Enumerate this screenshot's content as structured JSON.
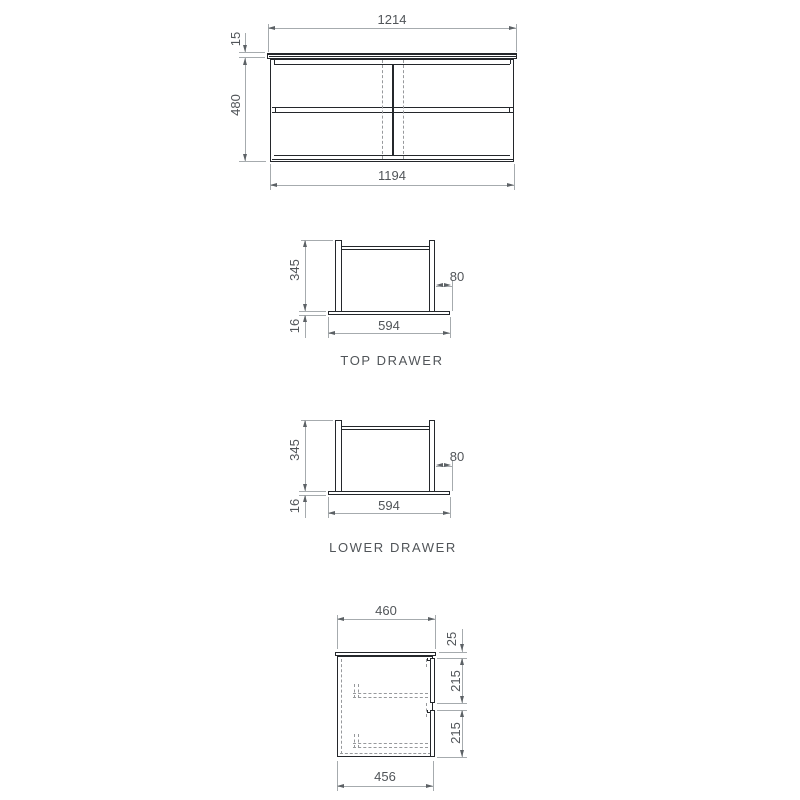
{
  "front_view": {
    "top_width": "1214",
    "top_thickness": "15",
    "height": "480",
    "carcass_width": "1194"
  },
  "top_drawer": {
    "caption": "TOP DRAWER",
    "height": "345",
    "runner_offset": "80",
    "base_thickness": "16",
    "width": "594"
  },
  "lower_drawer": {
    "caption": "LOWER DRAWER",
    "height": "345",
    "runner_offset": "80",
    "base_thickness": "16",
    "width": "594"
  },
  "side_view": {
    "top_depth": "460",
    "top_thickness": "25",
    "upper_front_height": "215",
    "lower_front_height": "215",
    "carcass_depth": "456"
  },
  "colors": {
    "object_line": "#24272b",
    "dimension_line": "#a6abae",
    "dashed_line": "#97999c",
    "text": "#515559",
    "background": "#ffffff"
  }
}
